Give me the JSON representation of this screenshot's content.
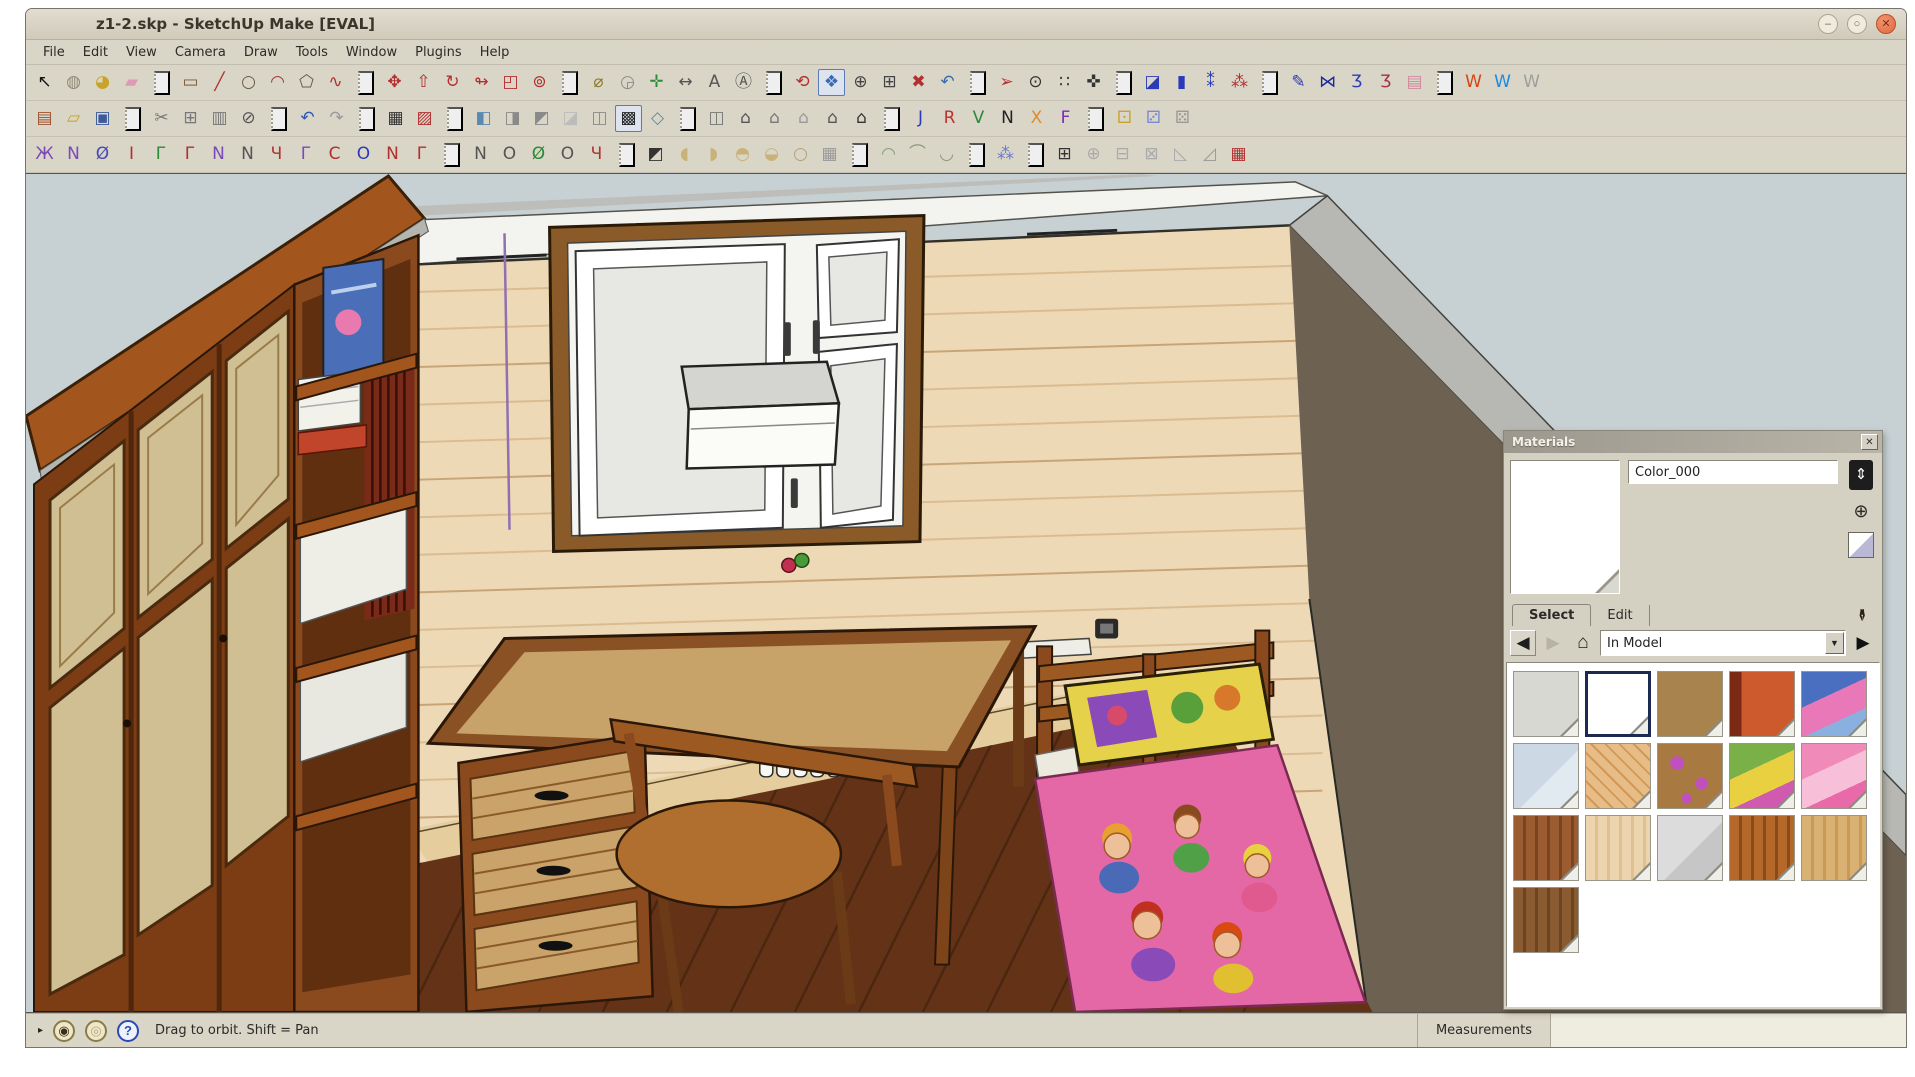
{
  "window": {
    "title": "z1-2.skp - SketchUp Make [EVAL]",
    "controls": [
      {
        "n": "minimize-button",
        "glyph": "–",
        "cls": "min"
      },
      {
        "n": "maximize-button",
        "glyph": "○",
        "cls": "max"
      },
      {
        "n": "close-button",
        "glyph": "✕",
        "cls": "close"
      }
    ]
  },
  "menu": {
    "items": [
      "File",
      "Edit",
      "View",
      "Camera",
      "Draw",
      "Tools",
      "Window",
      "Plugins",
      "Help"
    ]
  },
  "toolbars": {
    "row1": [
      {
        "n": "select-tool-button",
        "g": "↖",
        "c": "#141414"
      },
      {
        "n": "make-component-button",
        "g": "◍",
        "c": "#8f8a76"
      },
      {
        "n": "paint-bucket-button",
        "g": "◕",
        "c": "#c9a227"
      },
      {
        "n": "eraser-button",
        "g": "▰",
        "c": "#de9ab5"
      },
      {
        "sep": 1
      },
      {
        "n": "rectangle-tool-button",
        "g": "▭",
        "c": "#7a5a3a"
      },
      {
        "n": "line-tool-button",
        "g": "╱",
        "c": "#b23030"
      },
      {
        "n": "circle-tool-button",
        "g": "○",
        "c": "#6a5a48"
      },
      {
        "n": "arc-tool-button",
        "g": "◠",
        "c": "#b23030"
      },
      {
        "n": "polygon-tool-button",
        "g": "⬠",
        "c": "#6a5a48"
      },
      {
        "n": "freehand-tool-button",
        "g": "∿",
        "c": "#b23030"
      },
      {
        "sep": 1
      },
      {
        "n": "move-tool-button",
        "g": "✥",
        "c": "#b23030"
      },
      {
        "n": "push-pull-tool-button",
        "g": "⇧",
        "c": "#b23030"
      },
      {
        "n": "rotate-tool-button",
        "g": "↻",
        "c": "#b23030"
      },
      {
        "n": "follow-me-tool-button",
        "g": "↬",
        "c": "#b23030"
      },
      {
        "n": "scale-tool-button",
        "g": "◰",
        "c": "#b23030"
      },
      {
        "n": "offset-tool-button",
        "g": "⊚",
        "c": "#b23030"
      },
      {
        "sep": 1
      },
      {
        "n": "tape-measure-button",
        "g": "⌀",
        "c": "#8a7a2a"
      },
      {
        "n": "protractor-button",
        "g": "◶",
        "c": "#8a8a8a"
      },
      {
        "n": "axes-tool-button",
        "g": "✛",
        "c": "#2a8a3a"
      },
      {
        "n": "dimension-tool-button",
        "g": "↔",
        "c": "#555555"
      },
      {
        "n": "text-tool-button",
        "g": "A",
        "c": "#555555"
      },
      {
        "n": "3d-text-tool-button",
        "g": "Ⓐ",
        "c": "#555555"
      },
      {
        "sep": 1
      },
      {
        "n": "orbit-tool-button",
        "g": "⟲",
        "c": "#b23030"
      },
      {
        "n": "pan-tool-button",
        "g": "❖",
        "c": "#3a6ab0",
        "active": 1
      },
      {
        "n": "zoom-tool-button",
        "g": "⊕",
        "c": "#444444"
      },
      {
        "n": "zoom-window-button",
        "g": "⊞",
        "c": "#444444"
      },
      {
        "n": "zoom-extents-button",
        "g": "✖",
        "c": "#b23030"
      },
      {
        "n": "previous-view-button",
        "g": "↶",
        "c": "#3a6ab0"
      },
      {
        "sep": 1
      },
      {
        "n": "position-camera-button",
        "g": "➢",
        "c": "#b23030"
      },
      {
        "n": "look-around-button",
        "g": "⊙",
        "c": "#333333"
      },
      {
        "n": "walk-tool-button",
        "g": "∷",
        "c": "#333333"
      },
      {
        "n": "compass-button",
        "g": "✜",
        "c": "#333333"
      },
      {
        "sep": 1
      },
      {
        "n": "construction-toolbar-a",
        "g": "◪",
        "c": "#2a3ab8"
      },
      {
        "n": "construction-toolbar-b",
        "g": "▮",
        "c": "#2a3ab8"
      },
      {
        "n": "construction-toolbar-c",
        "g": "⁑",
        "c": "#2a3ab8"
      },
      {
        "n": "construction-toolbar-d",
        "g": "⁂",
        "c": "#b23030"
      },
      {
        "sep": 1
      },
      {
        "n": "style-toolbar-a",
        "g": "✎",
        "c": "#2a3ab8"
      },
      {
        "n": "style-toolbar-b",
        "g": "⋈",
        "c": "#1a2a9a"
      },
      {
        "n": "style-toolbar-c",
        "g": "Ʒ",
        "c": "#2a3ab8"
      },
      {
        "n": "style-toolbar-d",
        "g": "Ʒ",
        "c": "#a03050"
      },
      {
        "n": "style-toolbar-e",
        "g": "▤",
        "c": "#d08aa0"
      },
      {
        "sep": 1
      },
      {
        "n": "warehouse-red-button",
        "g": "W",
        "c": "#d84315"
      },
      {
        "n": "warehouse-blue-button",
        "g": "W",
        "c": "#1e88e5"
      },
      {
        "n": "warehouse-gray-button",
        "g": "W",
        "c": "#9e9e9e"
      }
    ],
    "row2": [
      {
        "n": "new-file-button",
        "g": "▤",
        "c": "#a0522d"
      },
      {
        "n": "open-file-button",
        "g": "▱",
        "c": "#c9a227"
      },
      {
        "n": "save-file-button",
        "g": "▣",
        "c": "#3a5a9a"
      },
      {
        "sep": 1
      },
      {
        "n": "cut-button",
        "g": "✂",
        "c": "#777777"
      },
      {
        "n": "copy-button",
        "g": "⊞",
        "c": "#777777"
      },
      {
        "n": "paste-button",
        "g": "▥",
        "c": "#777777"
      },
      {
        "n": "delete-button",
        "g": "⊘",
        "c": "#555555"
      },
      {
        "sep": 1
      },
      {
        "n": "undo-button",
        "g": "↶",
        "c": "#2a5ab8"
      },
      {
        "n": "redo-button",
        "g": "↷",
        "c": "#999999"
      },
      {
        "sep": 1
      },
      {
        "n": "print-button",
        "g": "▦",
        "c": "#333333"
      },
      {
        "n": "model-info-button",
        "g": "▨",
        "c": "#b23030"
      },
      {
        "sep": 1
      },
      {
        "n": "view-iso-button",
        "g": "◧",
        "c": "#5a8ab0"
      },
      {
        "n": "view-top-button",
        "g": "◨",
        "c": "#8a8a8a"
      },
      {
        "n": "view-front-button",
        "g": "◩",
        "c": "#8a8a8a"
      },
      {
        "n": "view-right-button",
        "g": "◪",
        "c": "#bcbcbc"
      },
      {
        "n": "view-back-button",
        "g": "◫",
        "c": "#8a8a8a"
      },
      {
        "n": "view-styles-button",
        "g": "▩",
        "c": "#222222",
        "active": 1
      },
      {
        "n": "view-perspective-button",
        "g": "◇",
        "c": "#5a8ab0"
      },
      {
        "sep": 1
      },
      {
        "n": "scene-button-a",
        "g": "◫",
        "c": "#777777"
      },
      {
        "n": "scene-button-b",
        "g": "⌂",
        "c": "#555555"
      },
      {
        "n": "scene-button-c",
        "g": "⌂",
        "c": "#777777"
      },
      {
        "n": "scene-button-d",
        "g": "⌂",
        "c": "#999999"
      },
      {
        "n": "scene-button-e",
        "g": "⌂",
        "c": "#555555"
      },
      {
        "n": "scene-button-f",
        "g": "⌂",
        "c": "#333333"
      },
      {
        "sep": 1
      },
      {
        "n": "export-button-j",
        "g": "J",
        "c": "#2a3ab8"
      },
      {
        "n": "export-button-r",
        "g": "R",
        "c": "#c03030"
      },
      {
        "n": "export-button-v",
        "g": "V",
        "c": "#2a8a3a"
      },
      {
        "n": "export-button-n",
        "g": "N",
        "c": "#222222"
      },
      {
        "n": "export-button-x",
        "g": "X",
        "c": "#e08a2a"
      },
      {
        "n": "export-button-f",
        "g": "F",
        "c": "#7a2ab8"
      },
      {
        "sep": 1
      },
      {
        "n": "die-yellow-button",
        "g": "⚀",
        "c": "#c9a227"
      },
      {
        "n": "die-blue-button",
        "g": "⚂",
        "c": "#7a8ad0"
      },
      {
        "n": "die-gray-button",
        "g": "⚄",
        "c": "#999999"
      }
    ],
    "row3": [
      {
        "n": "bezier-tool-a",
        "g": "Ж",
        "c": "#7a4ab8"
      },
      {
        "n": "bezier-tool-b",
        "g": "N",
        "c": "#7a4ab8"
      },
      {
        "n": "bezier-tool-c",
        "g": "Ø",
        "c": "#4a4ab8"
      },
      {
        "n": "bezier-tool-d",
        "g": "I",
        "c": "#b23030"
      },
      {
        "n": "bezier-tool-e",
        "g": "Γ",
        "c": "#2a8a3a"
      },
      {
        "n": "bezier-tool-f",
        "g": "Γ",
        "c": "#b23030"
      },
      {
        "n": "bezier-tool-g",
        "g": "N",
        "c": "#7a4ab8"
      },
      {
        "n": "bezier-tool-h",
        "g": "N",
        "c": "#555555"
      },
      {
        "n": "bezier-tool-i",
        "g": "Ч",
        "c": "#b23030"
      },
      {
        "n": "bezier-tool-j",
        "g": "Γ",
        "c": "#7a4ab8"
      },
      {
        "n": "bezier-tool-k",
        "g": "C",
        "c": "#b23030"
      },
      {
        "n": "bezier-tool-l",
        "g": "O",
        "c": "#2a3ab8"
      },
      {
        "n": "bezier-tool-m",
        "g": "N",
        "c": "#b23030"
      },
      {
        "n": "bezier-tool-n",
        "g": "Γ",
        "c": "#b23030"
      },
      {
        "sep": 1
      },
      {
        "n": "curve-tool-a",
        "g": "N",
        "c": "#555555"
      },
      {
        "n": "curve-tool-b",
        "g": "O",
        "c": "#555555"
      },
      {
        "n": "curve-tool-c",
        "g": "Ø",
        "c": "#2a8a3a"
      },
      {
        "n": "curve-tool-d",
        "g": "O",
        "c": "#555555"
      },
      {
        "n": "curve-tool-e",
        "g": "Ч",
        "c": "#b23030"
      },
      {
        "sep": 1
      },
      {
        "n": "terrain-tool-a",
        "g": "◩",
        "c": "#333333"
      },
      {
        "n": "terrain-tool-b",
        "g": "◖",
        "c": "#c9b27a"
      },
      {
        "n": "terrain-tool-c",
        "g": "◗",
        "c": "#c9b27a"
      },
      {
        "n": "terrain-tool-d",
        "g": "◓",
        "c": "#c9b27a"
      },
      {
        "n": "terrain-tool-e",
        "g": "◒",
        "c": "#c9b27a"
      },
      {
        "n": "terrain-tool-f",
        "g": "○",
        "c": "#b0a27a"
      },
      {
        "n": "terrain-tool-g",
        "g": "▦",
        "c": "#999999"
      },
      {
        "sep": 1
      },
      {
        "n": "shell-tool-a",
        "g": "◠",
        "c": "#8a9a7a"
      },
      {
        "n": "shell-tool-b",
        "g": "⌒",
        "c": "#8a9a7a"
      },
      {
        "n": "shell-tool-c",
        "g": "◡",
        "c": "#8a9a7a"
      },
      {
        "sep": 1
      },
      {
        "n": "label-tool-button",
        "g": "⁂",
        "c": "#6a7ad0"
      },
      {
        "sep": 1
      },
      {
        "n": "widget-tool-a",
        "g": "⊞",
        "c": "#333333"
      },
      {
        "n": "widget-tool-b",
        "g": "⊕",
        "c": "#aaaaaa"
      },
      {
        "n": "widget-tool-c",
        "g": "⊟",
        "c": "#aaaaaa"
      },
      {
        "n": "widget-tool-d",
        "g": "⊠",
        "c": "#aaaaaa"
      },
      {
        "n": "widget-tool-e",
        "g": "◺",
        "c": "#aaaaaa"
      },
      {
        "n": "widget-tool-f",
        "g": "◿",
        "c": "#999999"
      },
      {
        "n": "widget-tool-g",
        "g": "▦",
        "c": "#b23030"
      }
    ]
  },
  "materials_panel": {
    "title": "Materials",
    "close_glyph": "✕",
    "material_name": "Color_000",
    "side_icons": [
      {
        "n": "secondary-pane-icon",
        "glyph": "⇕"
      },
      {
        "n": "create-material-icon",
        "glyph": "⊕"
      }
    ],
    "tabs": [
      {
        "label": "Select",
        "active": 1
      },
      {
        "label": "Edit"
      }
    ],
    "eyedropper_glyph": "✒",
    "nav": {
      "back": "◀",
      "forward": "▶",
      "home": "⌂",
      "detail": "▶"
    },
    "dropdown_value": "In Model",
    "dropdown_arrow": "▼",
    "swatches": [
      {
        "pattern": "solid",
        "colors": [
          "#d8d8d2"
        ]
      },
      {
        "pattern": "solid",
        "colors": [
          "#ffffff"
        ],
        "selected": 1
      },
      {
        "pattern": "solid",
        "colors": [
          "#a8834e"
        ]
      },
      {
        "pattern": "book",
        "colors": [
          "#cc5a2c",
          "#7a2a12"
        ]
      },
      {
        "pattern": "poster",
        "colors": [
          "#4a6fc0",
          "#e878b8",
          "#8ab0e0"
        ]
      },
      {
        "pattern": "glass",
        "colors": [
          "#ccd9e4",
          "#e2eaf1"
        ]
      },
      {
        "pattern": "parquet",
        "colors": [
          "#e8bc86",
          "#cf9a58"
        ]
      },
      {
        "pattern": "spots",
        "colors": [
          "#a87a42",
          "#c050c0"
        ]
      },
      {
        "pattern": "poster",
        "colors": [
          "#7ab048",
          "#e8d040",
          "#d05ab0"
        ]
      },
      {
        "pattern": "poster",
        "colors": [
          "#f08ab8",
          "#f8c0d8",
          "#e86aa8"
        ]
      },
      {
        "pattern": "wood",
        "colors": [
          "#9a5c30",
          "#7a4420"
        ]
      },
      {
        "pattern": "wood",
        "colors": [
          "#ecd5ae",
          "#dfc091"
        ]
      },
      {
        "pattern": "glass",
        "colors": [
          "#dcdcdc",
          "#c6c6c6"
        ]
      },
      {
        "pattern": "wood",
        "colors": [
          "#b4682a",
          "#8a4a1a"
        ]
      },
      {
        "pattern": "wood",
        "colors": [
          "#d9b273",
          "#c89a55"
        ]
      },
      {
        "pattern": "wood",
        "colors": [
          "#8a5a30",
          "#6b4422"
        ]
      }
    ]
  },
  "statusbar": {
    "context_arrow": "▸",
    "icons": [
      {
        "n": "geolocation-icon",
        "glyph": "◉",
        "cls": ""
      },
      {
        "n": "claim-credit-icon",
        "glyph": "◎",
        "cls": "pale"
      },
      {
        "n": "help-icon",
        "glyph": "?",
        "cls": "blue"
      }
    ],
    "hint": "Drag to orbit.  Shift = Pan",
    "measurements_label": "Measurements",
    "measurements_value": ""
  },
  "scene": {
    "colors": {
      "sky": "#c7d1d4",
      "ceiling": "#f3f3ef",
      "wall_siding": "#eed9b6",
      "wall_siding_line": "#d9bc93",
      "right_wall": "#6d6152",
      "wall_top_band": "#b7b7b3",
      "floor_dark": "#643317",
      "floor_light": "#e6cd9d",
      "wardrobe_front": "#7c3d14",
      "wardrobe_top": "#a2561e",
      "door_panel": "#d0bf92",
      "desk_top": "#c7a369",
      "desk_wood": "#8a4a1e",
      "chair": "#b06f2e",
      "radiator": "#f7f7f3",
      "bed_blanket": "#e468a6",
      "pillow": "#e6d24a",
      "poster_blue": "#4a6fb8",
      "edge_guide_purple": "#9070b0"
    }
  }
}
